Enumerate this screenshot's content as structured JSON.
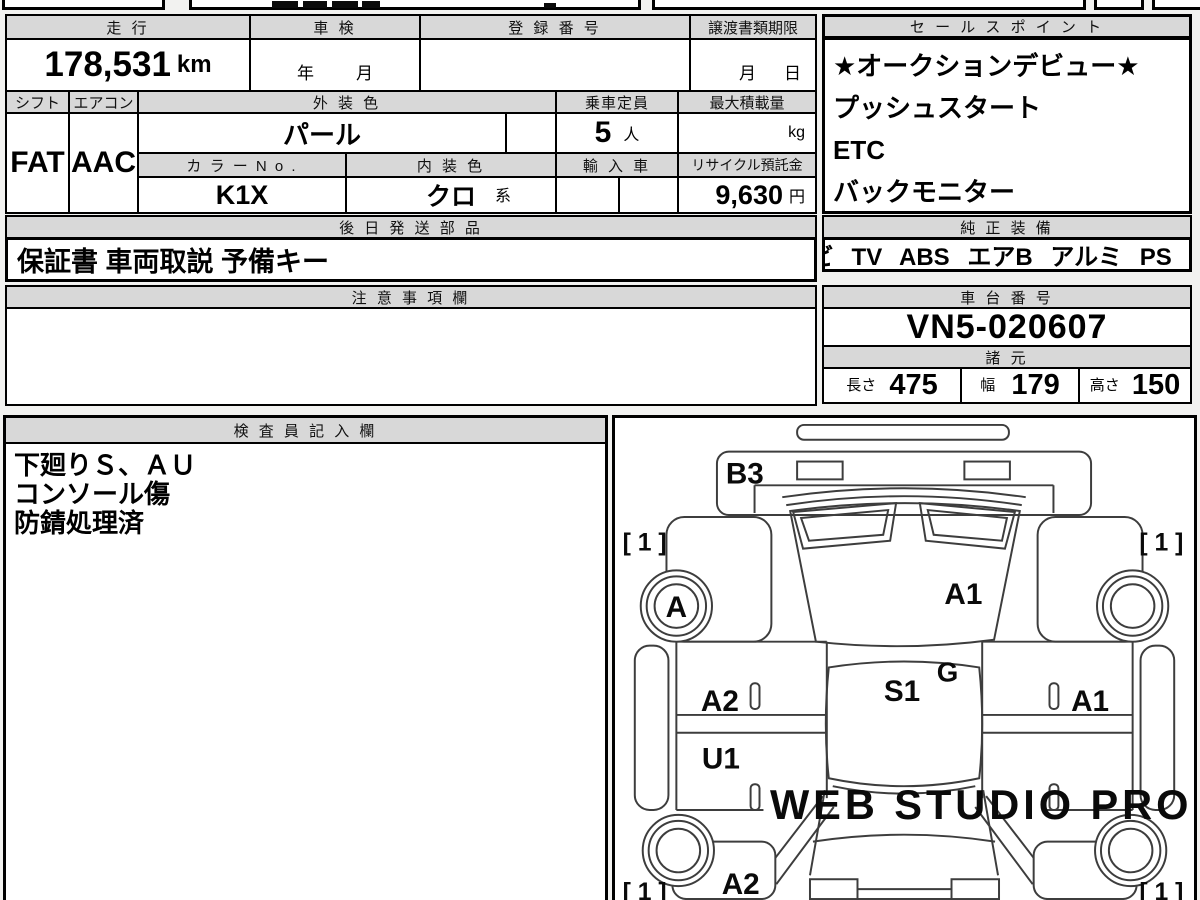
{
  "top_table": {
    "mileage_label": "走 行",
    "mileage_value": "178,531",
    "mileage_unit": "km",
    "inspection_label": "車 検",
    "inspection_year": "年",
    "inspection_month": "月",
    "registration_label": "登 録 番 号",
    "registration_value": "",
    "transfer_label": "譲渡書類期限",
    "transfer_month": "月",
    "transfer_day": "日",
    "shift_label": "シフト",
    "shift_value": "FAT",
    "aircon_label": "エアコン",
    "aircon_value": "AAC",
    "exterior_label": "外 装 色",
    "exterior_value": "パール",
    "capacity_label": "乗車定員",
    "capacity_value": "5",
    "capacity_unit": "人",
    "maxload_label": "最大積載量",
    "maxload_unit": "kg",
    "colorno_label": "カ ラ ー N o .",
    "colorno_value": "K1X",
    "interior_label": "内 装 色",
    "interior_value": "クロ",
    "interior_suffix": "系",
    "import_label": "輸 入 車",
    "recycle_label": "リサイクル預託金",
    "recycle_value": "9,630",
    "recycle_unit": "円",
    "parts_label": "後 日 発 送 部 品",
    "parts_value": "保証書 車両取説 予備キー",
    "caution_label": "注 意 事 項 欄"
  },
  "sales": {
    "label": "セ ー ル ス ポ イ ン ト",
    "items": [
      "★オークションデビュー★",
      "プッシュスタート",
      "ETC",
      "バックモニター"
    ]
  },
  "equipment": {
    "label": "純 正 装 備",
    "value": "ナビ TV ABS エアB アルミ PS PW"
  },
  "chassis": {
    "label": "車 台 番 号",
    "value": "VN5-020607"
  },
  "specs": {
    "label": "諸 元",
    "length_label": "長さ",
    "length_value": "475",
    "width_label": "幅",
    "width_value": "179",
    "height_label": "高さ",
    "height_value": "150"
  },
  "inspector": {
    "label": "検 査 員 記 入 欄",
    "lines": [
      "下廻りＳ、ＡＵ",
      "コンソール傷",
      "防錆処理済"
    ]
  },
  "diagram": {
    "corner_mark": "[ 1 ]",
    "front_bumper": "B3",
    "front_left_wheel": "A",
    "hood": "A1",
    "cowl": "G",
    "roof": "S1",
    "left_front_door": "A2",
    "left_rear_door": "U1",
    "right_front_door": "A1",
    "left_rear_quarter": "A2",
    "watermark": "WEB STUDIO PRO"
  }
}
